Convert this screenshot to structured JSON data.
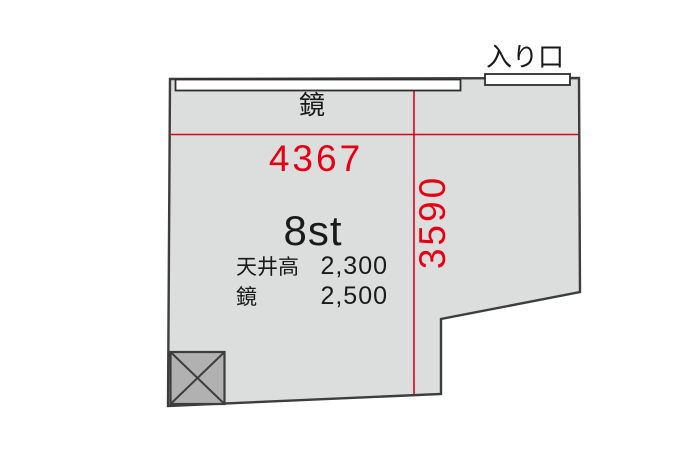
{
  "floorplan": {
    "room_name": "8st",
    "entrance_label": "入り口",
    "mirror_label": "鏡",
    "dimensions": {
      "width_mm": "4367",
      "depth_mm": "3590"
    },
    "specs": [
      {
        "label": "天井高",
        "value": "2,300"
      },
      {
        "label": "鏡",
        "value": "2,500"
      }
    ],
    "colors": {
      "dimension_red": "#e60012",
      "room_fill": "#dcdddd",
      "outline": "#3d3d3d",
      "pillar_fill": "#b1b1b2",
      "fixture_white": "#ffffff"
    }
  }
}
